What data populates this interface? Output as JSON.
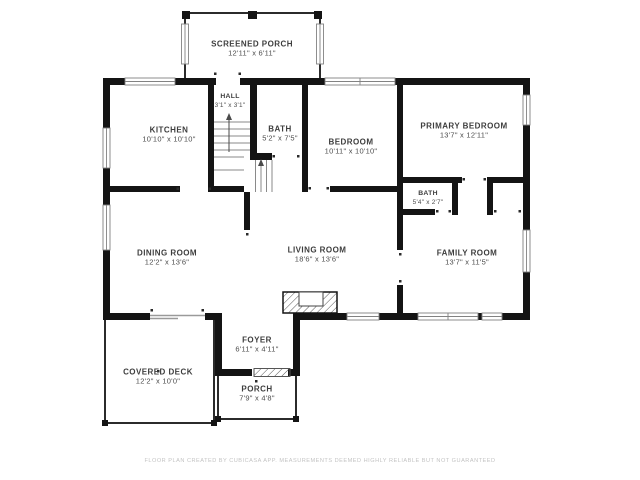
{
  "title": "Floor Plan",
  "colors": {
    "wall": "#141414",
    "thin_wall": "#2b2b2b",
    "stair_line": "#8a8a8a",
    "label_text": "#3d3d3d",
    "footer_text": "#c3c3c3",
    "background": "#ffffff"
  },
  "rooms": {
    "screened_porch": {
      "name": "SCREENED PORCH",
      "dims": "12'11\" x 6'11\""
    },
    "hall": {
      "name": "HALL",
      "dims": "3'1\" x 3'1\""
    },
    "kitchen": {
      "name": "KITCHEN",
      "dims": "10'10\" x 10'10\""
    },
    "bath": {
      "name": "BATH",
      "dims": "5'2\" x 7'5\""
    },
    "bedroom": {
      "name": "BEDROOM",
      "dims": "10'11\" x 10'10\""
    },
    "primary_bedroom": {
      "name": "PRIMARY BEDROOM",
      "dims": "13'7\" x 12'11\""
    },
    "bath2": {
      "name": "BATH",
      "dims": "5'4\" x 2'7\""
    },
    "dining_room": {
      "name": "DINING ROOM",
      "dims": "12'2\" x 13'6\""
    },
    "living_room": {
      "name": "LIVING ROOM",
      "dims": "18'6\" x 13'6\""
    },
    "family_room": {
      "name": "FAMILY ROOM",
      "dims": "13'7\" x 11'5\""
    },
    "foyer": {
      "name": "FOYER",
      "dims": "6'11\" x 4'11\""
    },
    "covered_deck": {
      "name": "COVERED DECK",
      "dims": "12'2\" x 10'0\""
    },
    "porch": {
      "name": "PORCH",
      "dims": "7'9\" x 4'8\""
    }
  },
  "footer": {
    "disclaimer": "FLOOR PLAN CREATED BY CUBICASA APP. MEASUREMENTS DEEMED HIGHLY RELIABLE BUT NOT GUARANTEED"
  }
}
